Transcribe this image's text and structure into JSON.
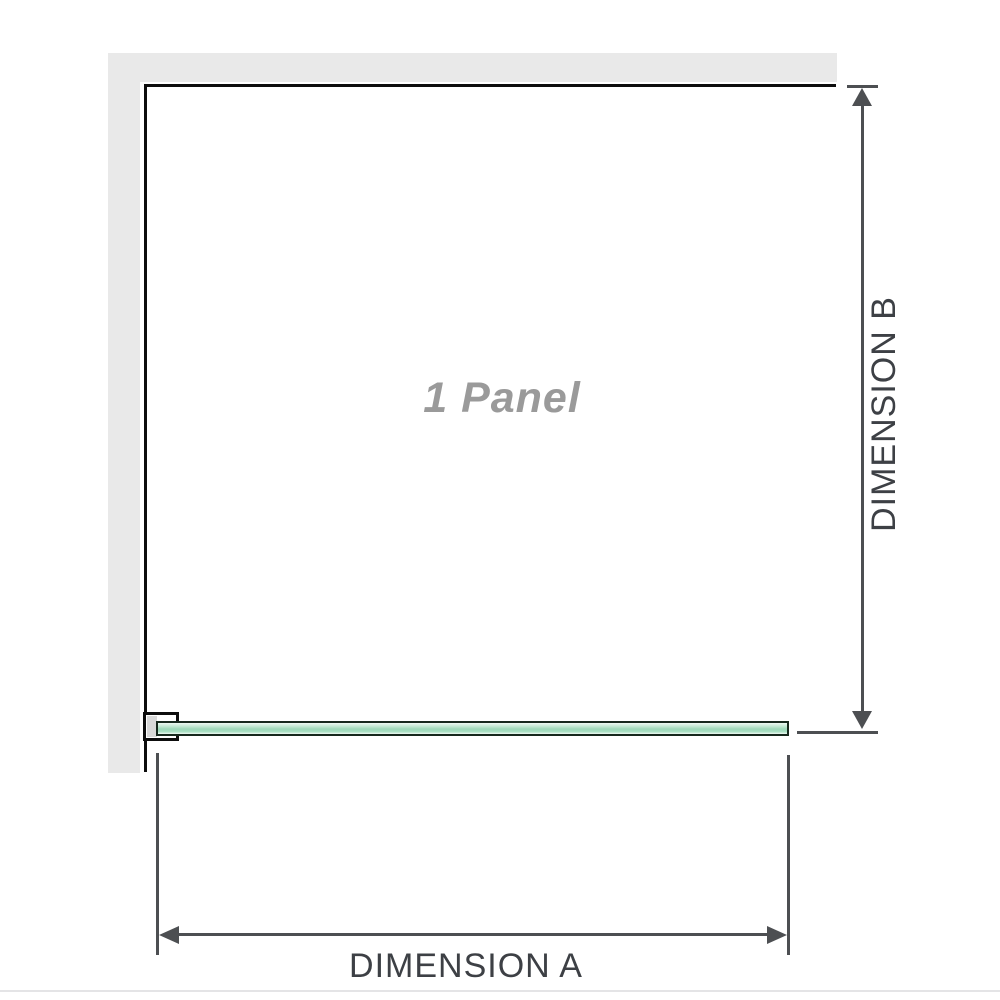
{
  "diagram": {
    "title": "1 Panel shower screen dimension diagram",
    "panel_label": "1 Panel",
    "dimension_a_label": "DIMENSION A",
    "dimension_b_label": "DIMENSION B"
  },
  "colors": {
    "wall": "#e9e9e9",
    "outline": "#0d0d0d",
    "dimension": "#4d4f52",
    "label_text": "#3d4045",
    "panel_text": "#9a9a9a",
    "glass_border": "#16281d",
    "glass_light": "#eef9f3",
    "glass_mid": "#9cd8b8",
    "glass_deep": "#a8dfc2",
    "divider": "#e4e4e6"
  }
}
